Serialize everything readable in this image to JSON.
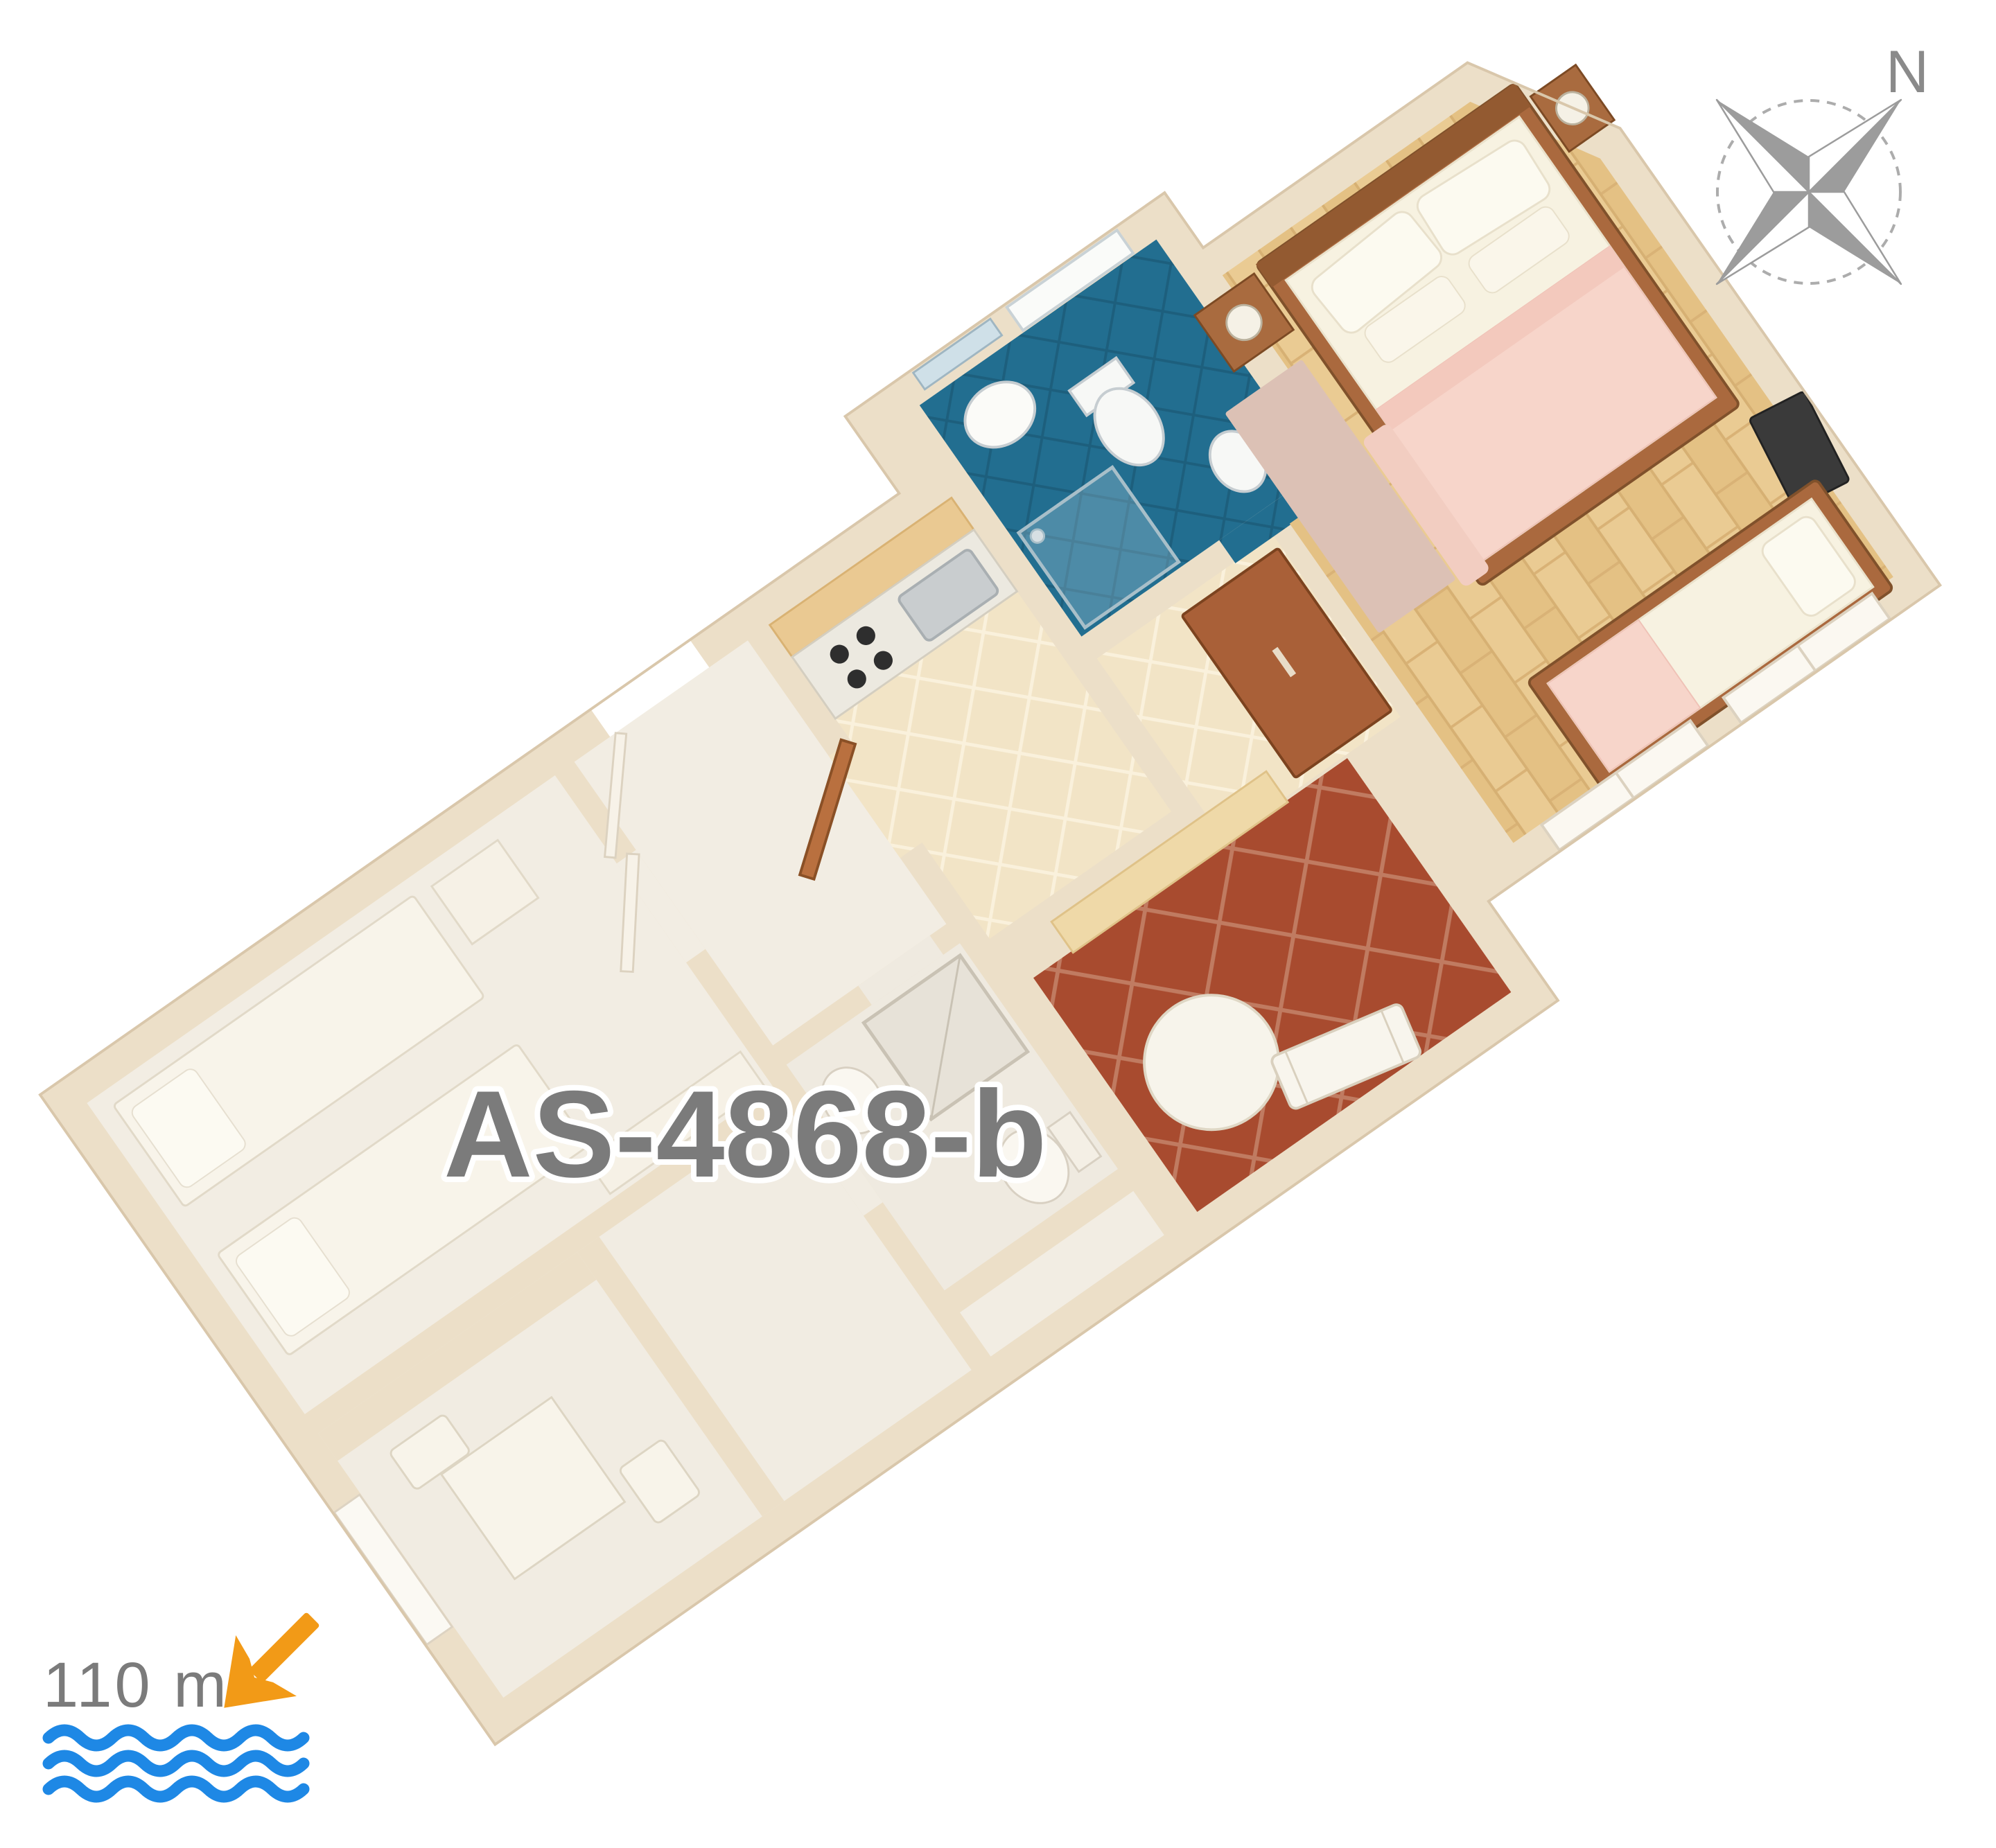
{
  "floorplan": {
    "unit_label": "AS-4868-b",
    "compass": {
      "north_label": "N"
    },
    "distance_to_sea": {
      "label": "110 m"
    },
    "icons": {
      "compass_rose": "four-point-star-with-dashed-circle",
      "distance_arrow": "orange-arrow-pointing-down-left-to-sea",
      "sea_waves": "three-blue-wavy-lines"
    },
    "colors": {
      "label_gray": "#7b7b7b",
      "north_gray": "#8a8a8a",
      "compass_gray": "#9c9c9c",
      "arrow_orange": "#F29A17",
      "wave_blue": "#1E88E5",
      "wall_cream": "#ECDFC8",
      "wall_edge": "#D9C7AB",
      "neighbor_floor_white": "#F2EDE3",
      "wood_floor": "#EACB93",
      "kitchen_tile_beige": "#F2E4C6",
      "bathroom_tile_blue": "#226E90",
      "terrace_terracotta": "#A84B2F",
      "furniture_brown": "#AA693E",
      "door_brown": "#B9703F",
      "bedding_pink": "#F7D5CA",
      "bedding_cream": "#F7F2E1",
      "rug_pink": "#DCC1B5",
      "tv_dark": "#3A3A3A"
    }
  }
}
